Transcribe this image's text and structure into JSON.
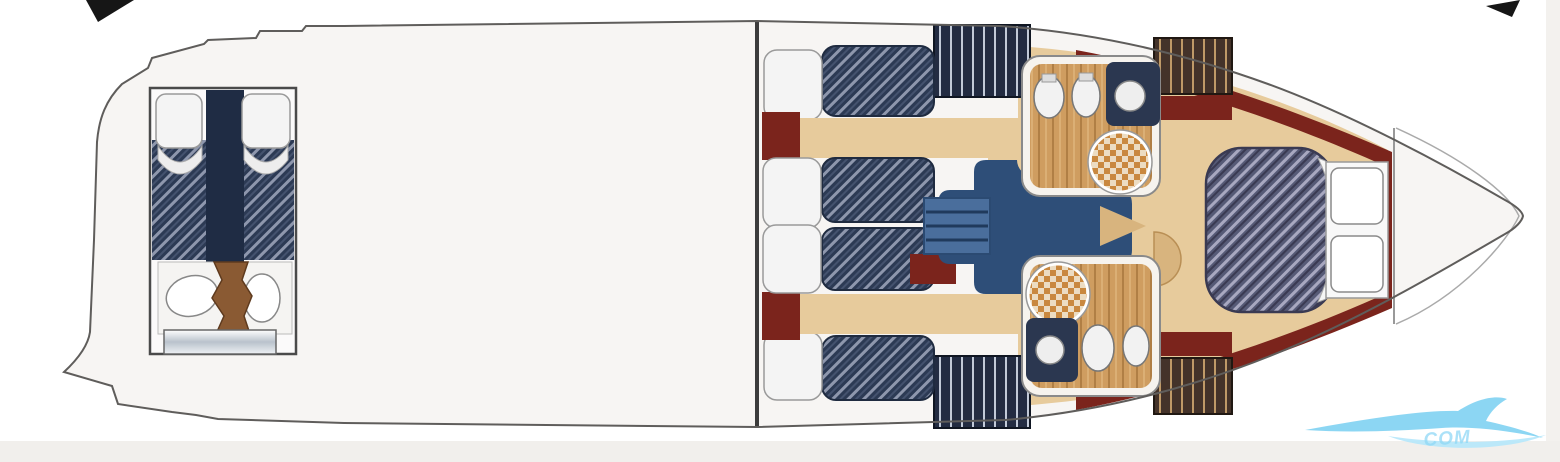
{
  "image": {
    "type": "yacht-floor-plan",
    "view": "top-down-deck-layout"
  },
  "colors": {
    "page_bg": "#ffffff",
    "hull_fill": "#f7f5f3",
    "hull_outline": "#5f5d5b",
    "floor_tan": "#e7cb9c",
    "floor_tan_dark": "#d8b47e",
    "maroon_trim": "#7b241c",
    "mattress_navy": "#2c3a54",
    "bow_bed_slate": "#565a76",
    "saloon_blue": "#2e4e78",
    "steps_blue": "#4a6e9c",
    "wood_brown": "#8a5a33",
    "bath_wood": "#cf9d60",
    "curtain_navy": "#232c42",
    "curtain_brown": "#44332a",
    "pillow_white": "#f4f4f4",
    "divider_dark": "#3c3c3c",
    "strip_gray_bottom": "#f1efec",
    "strip_gray_right": "#f3f1ee",
    "corner_marker_black": "#161616",
    "watermark_blue": "#7fd2f2",
    "watermark_blue_light": "#b5e7fb",
    "watermark_text_blue": "#8fd8f6"
  },
  "watermark": {
    "text": "COM",
    "color": "#8fd8f6"
  },
  "corner_markers": {
    "top_left": "arrow-fragment",
    "top_right": "arrow-fragment"
  },
  "plan": {
    "rooms": [
      {
        "id": "aft-cabin",
        "name": "aft twin-berth cabin with vanity and steps"
      },
      {
        "id": "main-deck",
        "name": "open undetailed deck area"
      },
      {
        "id": "guest-cabin-top",
        "name": "side cabin with two berths"
      },
      {
        "id": "guest-cabin-bottom",
        "name": "side cabin with two berths"
      },
      {
        "id": "head-top",
        "name": "bathroom with round shower tray, sinks, toilet"
      },
      {
        "id": "head-bottom",
        "name": "bathroom with round shower tray, sinks, toilet"
      },
      {
        "id": "companionway",
        "name": "central blue companionway with steps"
      },
      {
        "id": "bow-cabin",
        "name": "bow owner cabin with double berth and pillows"
      }
    ],
    "fixtures": [
      "beds-with-pillows",
      "checkered-shower-trays",
      "toilets",
      "sinks",
      "wardrobe-curtain-panels",
      "wooden-steps",
      "maroon-hull-trim"
    ]
  }
}
